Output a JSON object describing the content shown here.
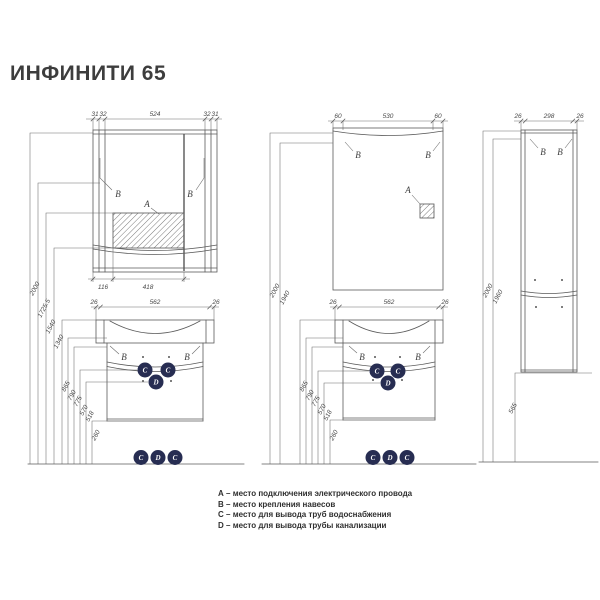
{
  "title": "ИНФИНИТИ 65",
  "markers": {
    "a": "A",
    "b": "B",
    "c": "C",
    "d": "D"
  },
  "left_drawing": {
    "mirror_top_dims": [
      "31",
      "32",
      "524",
      "32",
      "31"
    ],
    "mirror_bottom_dims": [
      "116",
      "418"
    ],
    "vanity_top_dims": [
      "26",
      "562",
      "26"
    ],
    "vertical_dims": [
      "2000",
      "1725.5",
      "1540",
      "1340",
      "865",
      "790",
      "775",
      "570",
      "518",
      "260"
    ]
  },
  "right_drawing": {
    "mirror_top_dims": [
      "60",
      "530",
      "60"
    ],
    "vanity_top_dims": [
      "26",
      "562",
      "26"
    ],
    "vertical_dims": [
      "2000",
      "1940",
      "865",
      "790",
      "775",
      "570",
      "518",
      "260"
    ]
  },
  "column_drawing": {
    "top_dims": [
      "26",
      "298",
      "26"
    ],
    "vertical_dims": [
      "2000",
      "1960"
    ],
    "bottom_dim": "565"
  },
  "legend": {
    "items": [
      {
        "letter": "A",
        "text": "– место подключения электрического провода"
      },
      {
        "letter": "B",
        "text": "– место крепления навесов"
      },
      {
        "letter": "C",
        "text": "– место для вывода труб водоснабжения"
      },
      {
        "letter": "D",
        "text": "– место для вывода трубы канализации"
      }
    ]
  },
  "colors": {
    "line": "#5a5a5a",
    "pipe_circle": "#272d52",
    "text": "#3d3d3d"
  }
}
